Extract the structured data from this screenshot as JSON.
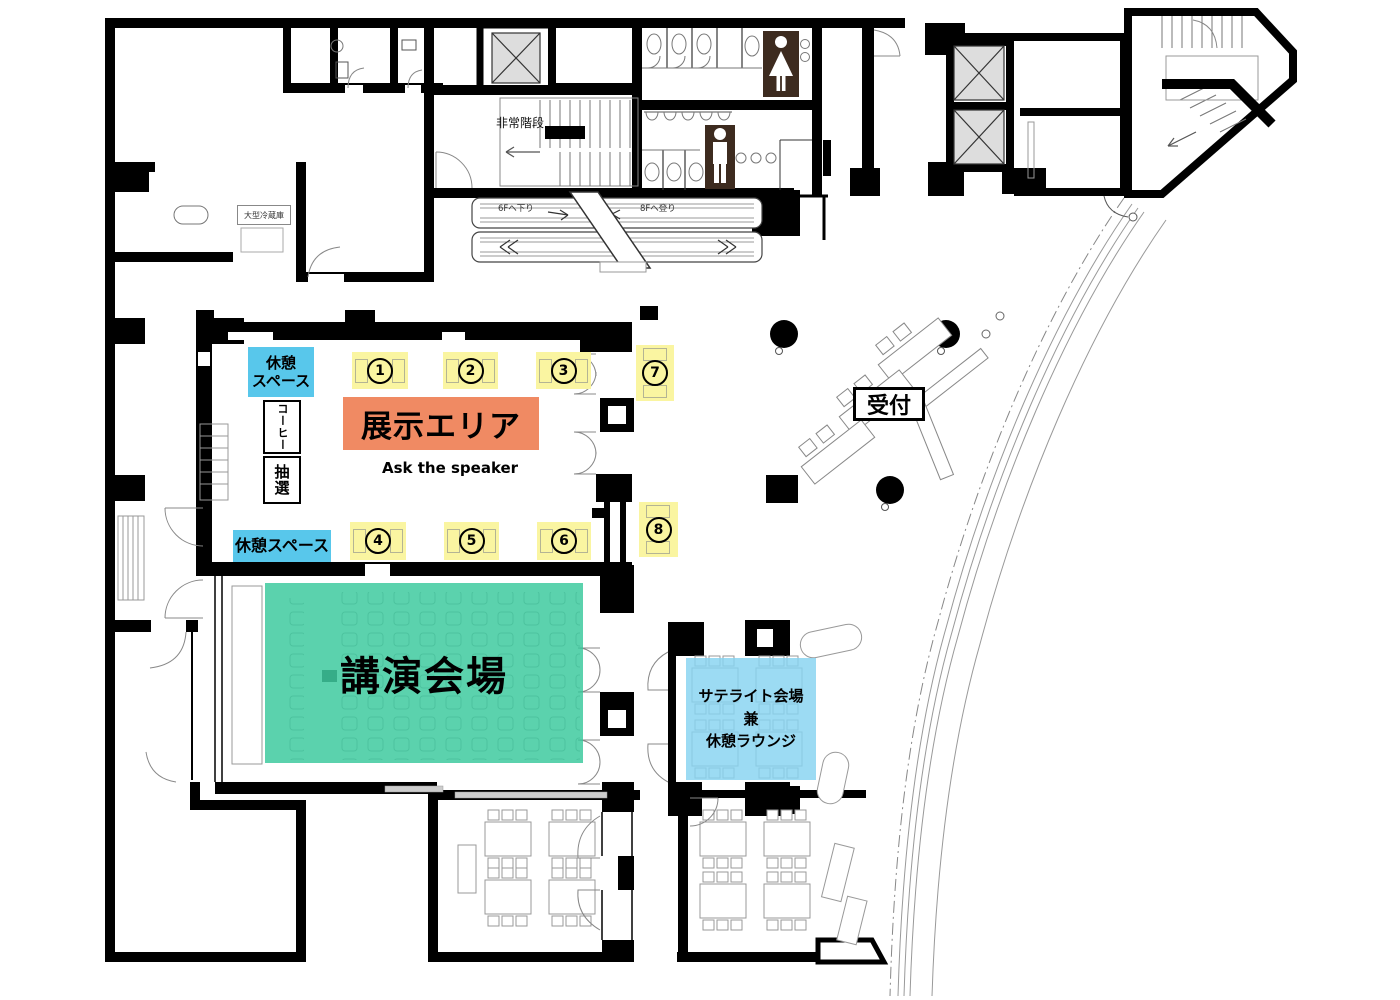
{
  "colors": {
    "wall": "#000000",
    "zone_yellow": "#FAF5A1",
    "zone_cyan": "#58C7EB",
    "zone_cyan_light": "#86D3F0",
    "zone_orange": "#F08A63",
    "zone_green": "#37C89B",
    "restroom_icon_brown": "#3D2B1F",
    "elevator_gray": "#DDDDDD"
  },
  "labels": {
    "exhibition_area": "展示エリア",
    "lecture_hall": "講演会場",
    "reception": "受付",
    "rest_space_top": [
      "休憩",
      "スペース"
    ],
    "rest_space_bottom": "休憩スペース",
    "satellite": [
      "サテライト会場",
      "兼",
      "休憩ラウンジ"
    ],
    "coffee": "コーヒー",
    "lottery": "抽選",
    "ask_the_speaker": "Ask the speaker",
    "emergency_stairs": "非常階段",
    "large_refrigerator": "大型冷蔵庫",
    "escalator_down_to_6f": "6Fへ下り",
    "escalator_up_to_8f": "8Fへ登り"
  },
  "booths": [
    {
      "number": "1"
    },
    {
      "number": "2"
    },
    {
      "number": "3"
    },
    {
      "number": "4"
    },
    {
      "number": "5"
    },
    {
      "number": "6"
    },
    {
      "number": "7"
    },
    {
      "number": "8"
    }
  ],
  "icons": {
    "female_restroom": "female-pictogram",
    "male_restroom": "male-pictogram",
    "elevator": "elevator-cross-box",
    "escalator": "escalator-bands",
    "stairs": "stair-treads"
  }
}
